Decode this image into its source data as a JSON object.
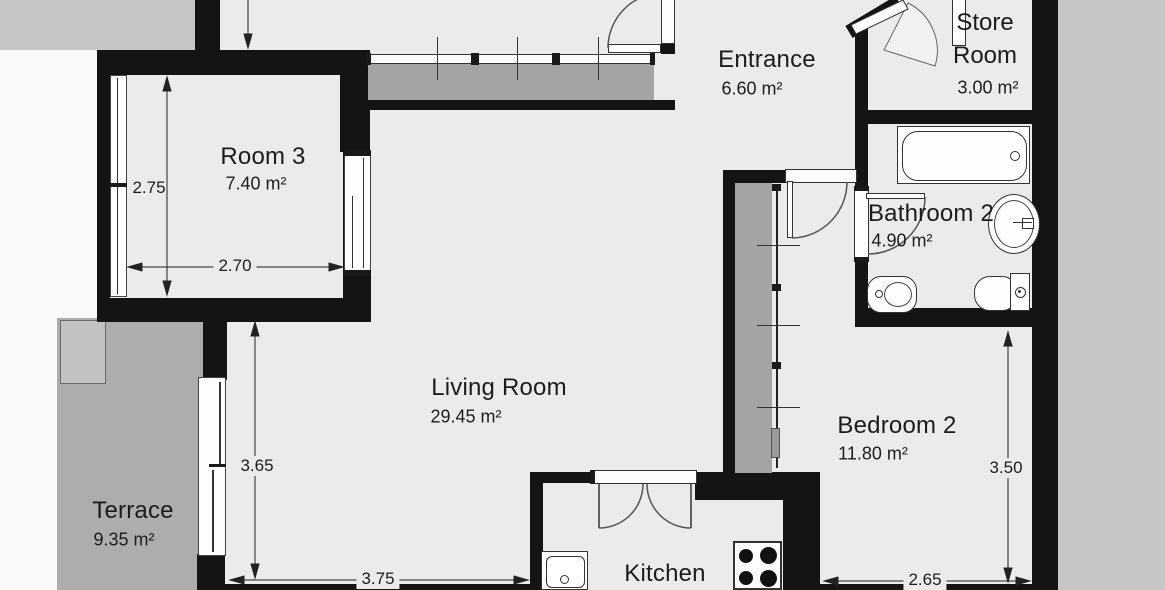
{
  "title": "Apartment floor plan",
  "rooms": [
    {
      "name": "Room 3",
      "area": "7.40 m²"
    },
    {
      "name": "Living Room",
      "area": "29.45 m²"
    },
    {
      "name": "Terrace",
      "area": "9.35 m²"
    },
    {
      "name": "Kitchen",
      "area": ""
    },
    {
      "name": "Entrance",
      "area": "6.60 m²"
    },
    {
      "name": "Store Room",
      "area": "3.00 m²"
    },
    {
      "name": "Bathroom 2",
      "area": "4.90 m²"
    },
    {
      "name": "Bedroom 2",
      "area": "11.80 m²"
    }
  ],
  "dimensions": [
    {
      "value": "2.75",
      "axis": "vertical",
      "measures": "Room 3 height"
    },
    {
      "value": "2.70",
      "axis": "horizontal",
      "measures": "Room 3 width"
    },
    {
      "value": "3.65",
      "axis": "vertical",
      "measures": "Living Room height"
    },
    {
      "value": "3.75",
      "axis": "horizontal",
      "measures": "Living Room width"
    },
    {
      "value": "3.50",
      "axis": "vertical",
      "measures": "Bedroom 2 height"
    },
    {
      "value": "2.65",
      "axis": "horizontal",
      "measures": "Bedroom 2 width"
    }
  ],
  "fixtures": [
    "bathtub",
    "bathroom-sink",
    "toilet",
    "bidet",
    "kitchen-sink",
    "stove-4-burners",
    "entrance-wardrobe-sliding",
    "bedroom-wardrobe-sliding",
    "double-swing-door-kitchen",
    "entrance-door",
    "bedroom-door",
    "bathroom-door",
    "store-room-door",
    "terrace-sliding-door",
    "window-room3-left",
    "window-room3-inner"
  ],
  "colors": {
    "wall": "#141414",
    "floor": "#ebebeb",
    "exterior": "#f9f9f9",
    "outside": "#c6c6c6",
    "terrace": "#adadad",
    "wardrobe": "#a4a4a4",
    "line": "#2a2a2a",
    "text": "#1c1c1c"
  }
}
